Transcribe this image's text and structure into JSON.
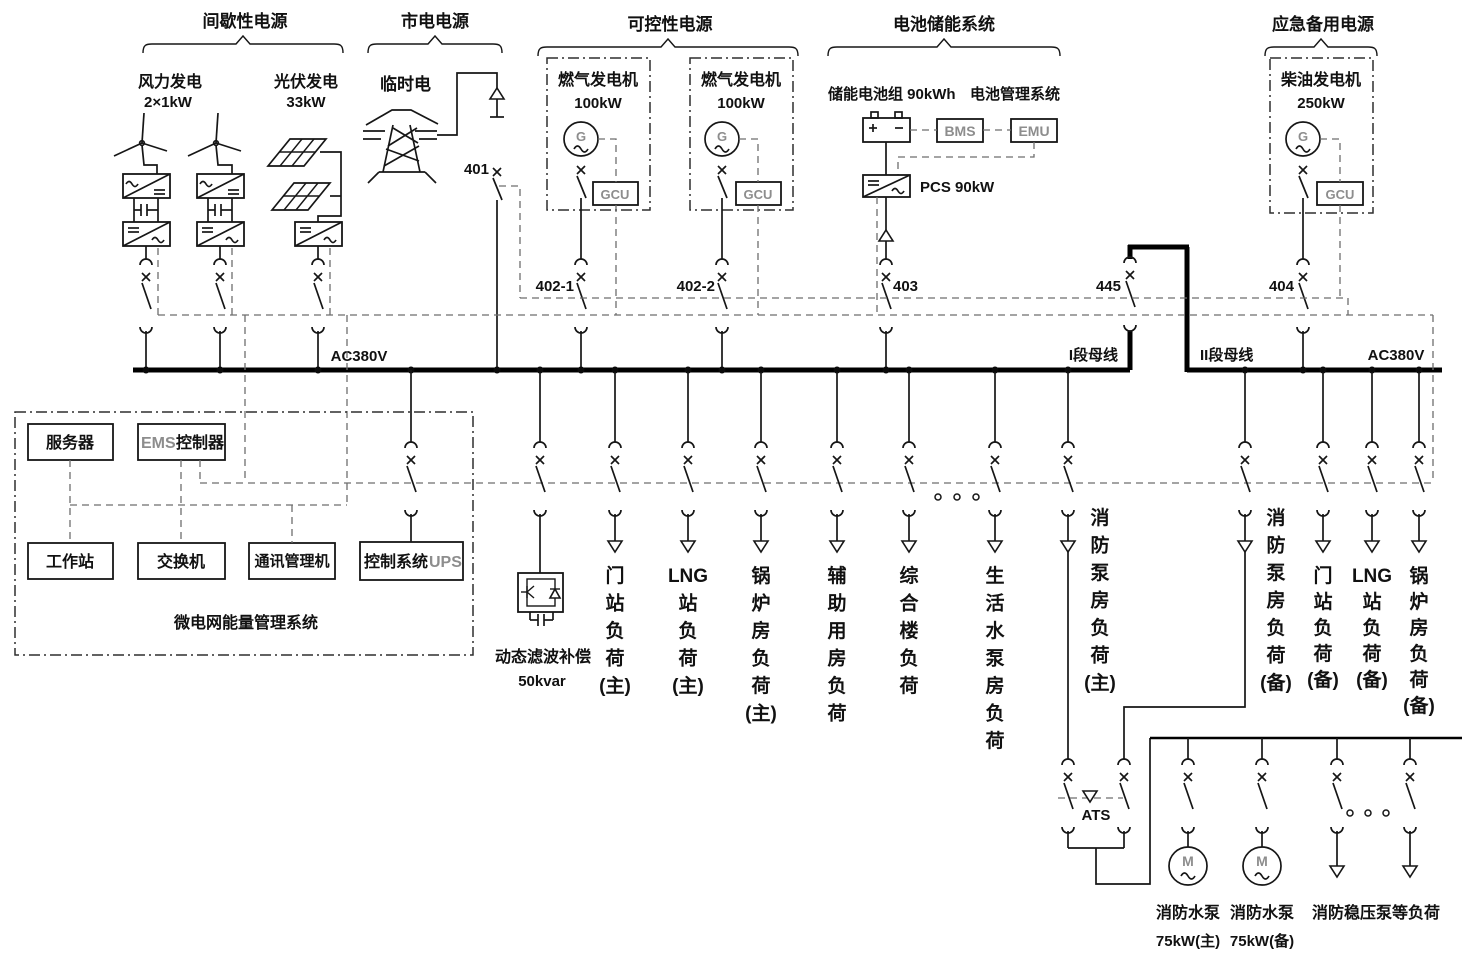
{
  "headers": {
    "intermittent": "间歇性电源",
    "utility": "市电电源",
    "controllable": "可控性电源",
    "battery_storage": "电池储能系统",
    "emergency": "应急备用电源"
  },
  "sources": {
    "wind": {
      "name": "风力发电",
      "rating": "2×1kW"
    },
    "pv": {
      "name": "光伏发电",
      "rating": "33kW"
    },
    "utility": {
      "name": "临时电"
    },
    "gas1": {
      "name": "燃气发电机",
      "rating": "100kW",
      "gen": "G",
      "gcu": "GCU"
    },
    "gas2": {
      "name": "燃气发电机",
      "rating": "100kW",
      "gen": "G",
      "gcu": "GCU"
    },
    "battery": {
      "pack": "储能电池组 90kWh",
      "mgmt": "电池管理系统",
      "bms": "BMS",
      "emu": "EMU",
      "pcs": "PCS 90kW"
    },
    "diesel": {
      "name": "柴油发电机",
      "rating": "250kW",
      "gen": "G",
      "gcu": "GCU"
    }
  },
  "breakers": {
    "b401": "401",
    "b402_1": "402-1",
    "b402_2": "402-2",
    "b403": "403",
    "b445": "445",
    "b404": "404"
  },
  "bus": {
    "ac_left": "AC380V",
    "ac_right": "AC380V",
    "sec1": "I段母线",
    "sec2": "II段母线"
  },
  "ems": {
    "server": "服务器",
    "ctrl_prefix": "EMS",
    "ctrl_suffix": "控制器",
    "workstation": "工作站",
    "switch": "交换机",
    "comm_manager": "通讯管理机",
    "ups_prefix": "控制系统",
    "ups_suffix": "UPS",
    "title": "微电网能量管理系统"
  },
  "filter": {
    "name": "动态滤波补偿",
    "rating": "50kvar"
  },
  "loads_bus1": [
    {
      "id": "gate-main",
      "lines": [
        "门",
        "站",
        "负",
        "荷",
        "(主)"
      ]
    },
    {
      "id": "lng-main",
      "lines": [
        "LNG",
        "站",
        "负",
        "荷",
        "(主)"
      ]
    },
    {
      "id": "boiler-main",
      "lines": [
        "锅",
        "炉",
        "房",
        "负",
        "荷",
        "(主)"
      ]
    },
    {
      "id": "aux-room",
      "lines": [
        "辅",
        "助",
        "用",
        "房",
        "负",
        "荷"
      ]
    },
    {
      "id": "complex-bldg",
      "lines": [
        "综",
        "合",
        "楼",
        "负",
        "荷"
      ]
    },
    {
      "id": "water-pump",
      "lines": [
        "生",
        "活",
        "水",
        "泵",
        "房",
        "负",
        "荷"
      ]
    },
    {
      "id": "fire-pump-main",
      "lines": [
        "消",
        "防",
        "泵",
        "房",
        "负",
        "荷",
        "(主)"
      ]
    }
  ],
  "loads_bus2": [
    {
      "id": "fire-pump-backup",
      "lines": [
        "消",
        "防",
        "泵",
        "房",
        "负",
        "荷",
        "(备)"
      ]
    },
    {
      "id": "gate-backup",
      "lines": [
        "门",
        "站",
        "负",
        "荷",
        "(备)"
      ]
    },
    {
      "id": "lng-backup",
      "lines": [
        "LNG",
        "站",
        "负",
        "荷",
        "(备)"
      ]
    },
    {
      "id": "boiler-backup",
      "lines": [
        "锅",
        "炉",
        "房",
        "负",
        "荷",
        "(备)"
      ]
    }
  ],
  "ats": {
    "label": "ATS"
  },
  "fire_system": {
    "pump_main": {
      "name": "消防水泵",
      "rating": "75kW(主)",
      "motor": "M"
    },
    "pump_backup": {
      "name": "消防水泵",
      "rating": "75kW(备)",
      "motor": "M"
    },
    "other_loads": "消防稳压泵等负荷"
  }
}
